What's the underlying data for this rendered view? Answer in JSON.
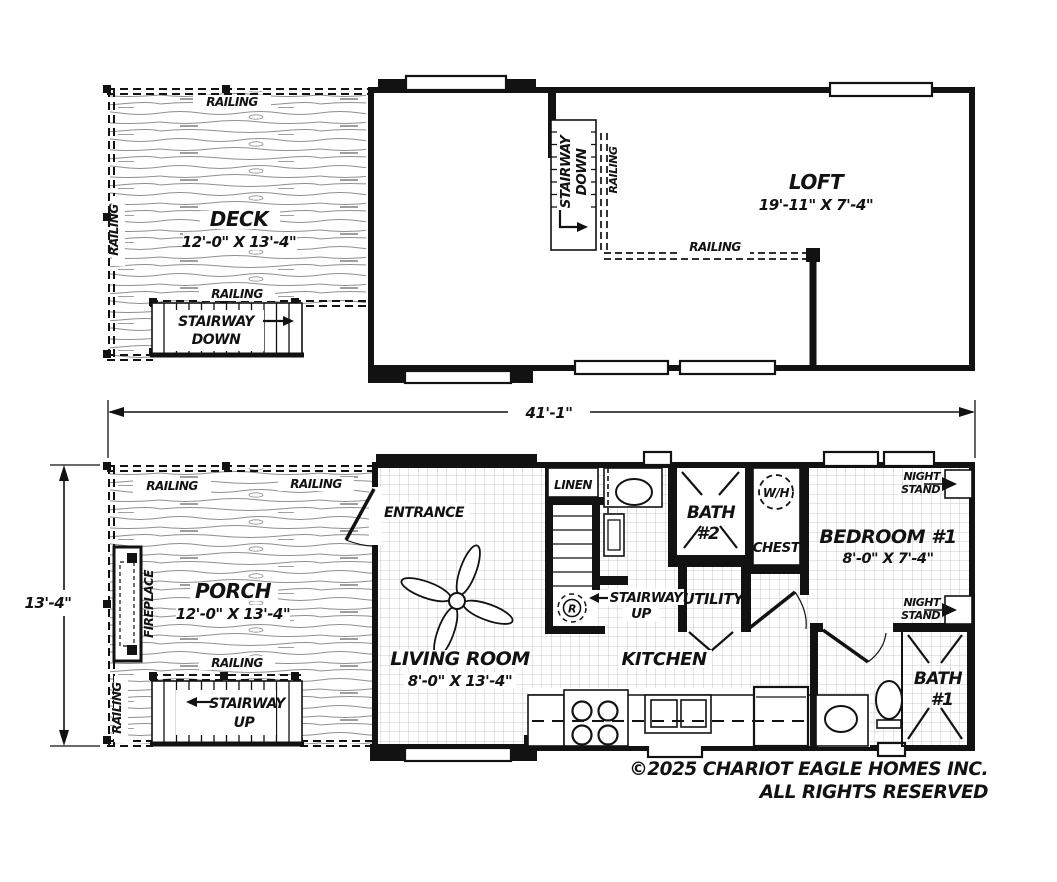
{
  "colors": {
    "ink": "#121212",
    "paper": "#ffffff",
    "wood_grain": "#8f8f8f",
    "tile_grid": "#bcbcbc"
  },
  "shared_labels": {
    "railing": "RAILING",
    "stairway": "STAIRWAY",
    "down": "DOWN",
    "up": "UP",
    "night": "NIGHT",
    "stand": "STAND"
  },
  "upper_floor": {
    "deck": {
      "name": "DECK",
      "size": "12'-0\" X 13'-4\""
    },
    "loft": {
      "name": "LOFT",
      "size": "19'-11\" X 7'-4\""
    }
  },
  "dimensions": {
    "overall_width": "41'-1\"",
    "side_height": "13'-4\""
  },
  "main_floor": {
    "porch": {
      "name": "PORCH",
      "size": "12'-0\" X 13'-4\"",
      "fireplace": "FIREPLACE"
    },
    "entrance": "ENTRANCE",
    "living_room": {
      "name": "LIVING ROOM",
      "size": "8'-0\" X 13'-4\""
    },
    "linen": "LINEN",
    "kitchen": "KITCHEN",
    "bath2": {
      "line1": "BATH",
      "line2": "#2"
    },
    "bath1": {
      "line1": "BATH",
      "line2": "#1"
    },
    "water_heater": "W/H",
    "chest": "CHEST",
    "utility": "UTILITY",
    "bedroom1": {
      "name": "BEDROOM #1",
      "size": "8'-0\" X 7'-4\""
    },
    "range_symbol": "R"
  },
  "footer": {
    "copyright_line1": "©2025 CHARIOT EAGLE HOMES INC.",
    "copyright_line2": "ALL RIGHTS RESERVED"
  }
}
